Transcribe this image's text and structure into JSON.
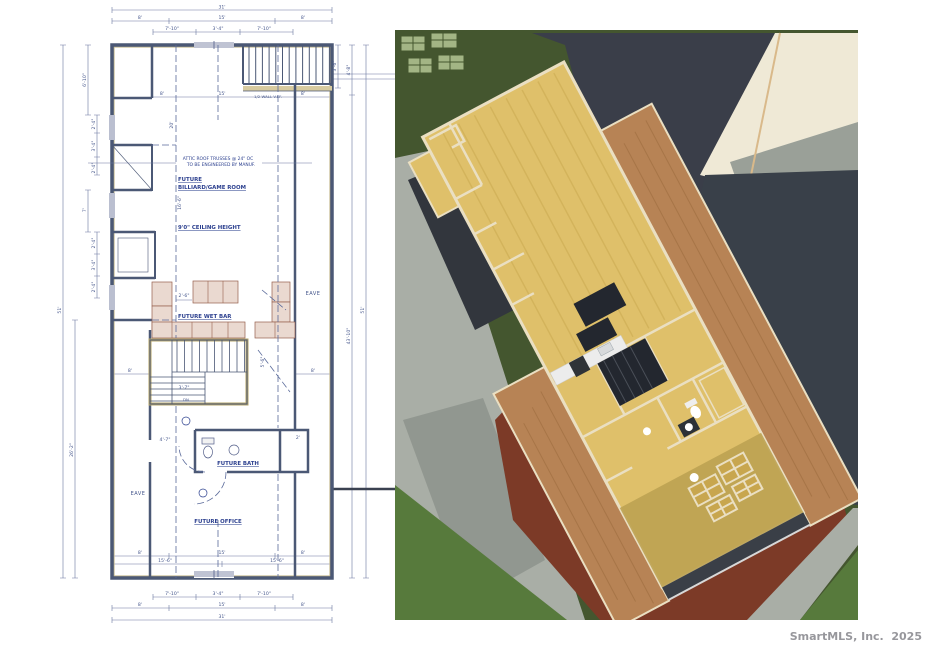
{
  "colors": {
    "plan_blue": "#2b3f8e",
    "plan_dim": "#46578c",
    "plan_wall": "#4b5875",
    "plan_tan": "#c5b98e",
    "cab_fill": "#ead9d0",
    "cab_edge": "#96604e",
    "wall_cream": "#eadfc2",
    "lawn": "#44562f",
    "lawn_light": "#577a3c",
    "beds": "#a3b585",
    "drive": "#a9aea6",
    "drive_dark": "#8d938c",
    "roof_dark": "#3a3e49",
    "cream": "#efe9d6",
    "gray_band": "#9aa098",
    "floor_wood": "#dfc06a",
    "floor_olive": "#bda252",
    "sheathing": "#b78355",
    "ground_red": "#7c3a27",
    "dark_open": "#23272f",
    "watermark": "#97979c"
  },
  "page": {
    "watermark": "SmartMLS, Inc.  2025"
  },
  "plan": {
    "rooms": {
      "future": "FUTURE",
      "billiard": "BILLIARD/GAME  ROOM",
      "ceiling": "9'0\" CEILING HEIGHT",
      "wet_bar": "FUTURE WET BAR",
      "bath": "FUTURE BATH",
      "office": "FUTURE OFFICE",
      "eave_left": "EAVE",
      "eave_right": "EAVE"
    },
    "notes": {
      "truss1": "ATTIC ROOF TRUSSES  @ 24\" OC",
      "truss2": "TO BE ENGINEERED BY MANUF.",
      "half_wall": "1/2 WALL V.I.F.",
      "dn": "DN"
    },
    "dims": {
      "t31": "31'",
      "t8l": "8'",
      "t15": "15'",
      "t8r": "8'",
      "t710l": "7'-10\"",
      "t34": "3'-4\"",
      "t710r": "7'-10\"",
      "ti8l": "8'",
      "ti15": "15'",
      "ti8r": "8'",
      "l610": "6'-10\"",
      "l24a": "2'-4\"",
      "l34a": "3'-4\"",
      "l24b": "2'-4\"",
      "l7": "7'",
      "l24c": "2'-4\"",
      "l34b": "3'-4\"",
      "l24d": "2'-4\"",
      "l262": "26'-2\"",
      "l51": "51'",
      "r36": "3'-6\"",
      "r48": "4'-8\"",
      "r4310": "43'-10\"",
      "r51": "51'",
      "i20": "20'",
      "i166": "16'-6\"",
      "i26": "2'-6\"",
      "i56": "5'-6\"",
      "i37": "3'-7\"",
      "i47": "4'-7\"",
      "i2": "2'",
      "e8l": "8'",
      "e8r": "8'",
      "bi8l": "8'",
      "bi15": "15'",
      "bi8r": "8'",
      "bi156l": "15'-6\"",
      "bi156r": "15'-6\"",
      "b710l": "7'-10\"",
      "b34": "3'-4\"",
      "b710r": "7'-10\"",
      "b8l": "8'",
      "b15": "15'",
      "b8r": "8'",
      "b31": "31'"
    }
  }
}
